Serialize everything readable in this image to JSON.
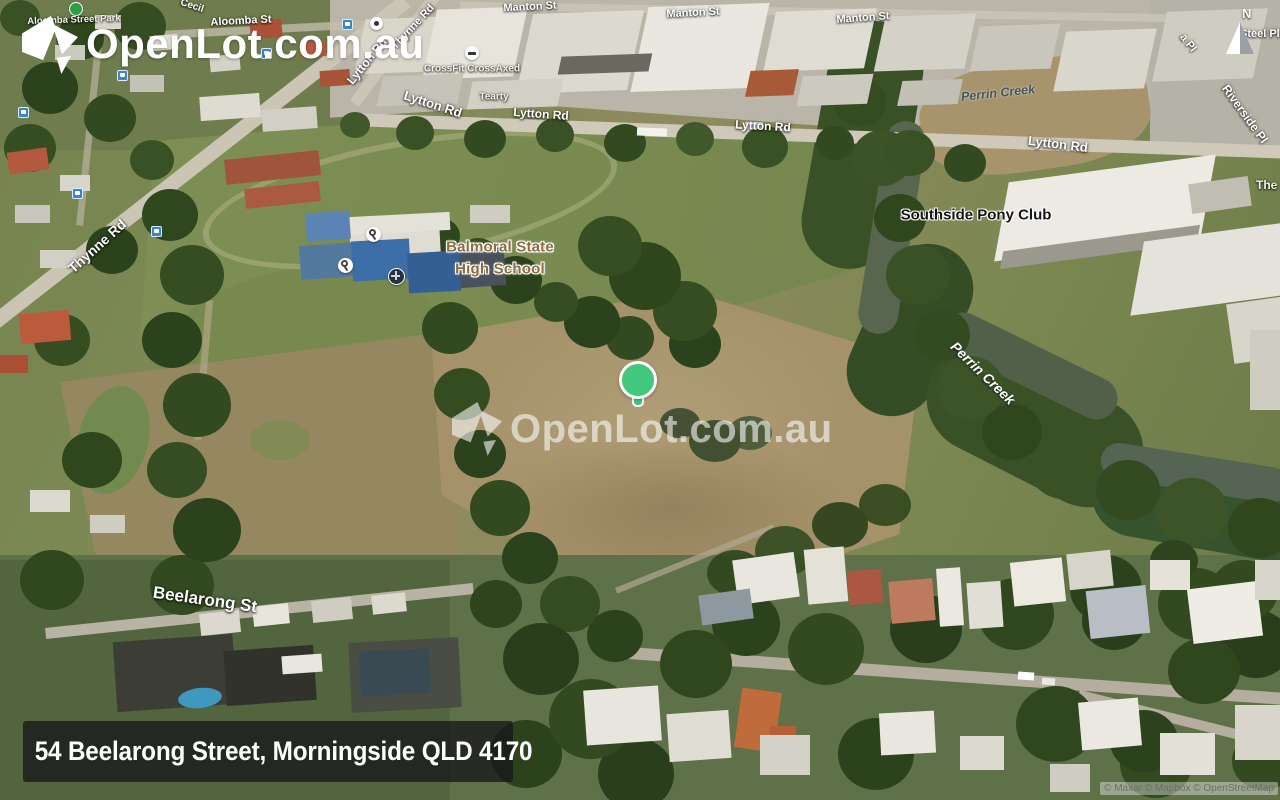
{
  "brand": {
    "logo_text": "OpenLot.com.au",
    "watermark_text": "OpenLot.com.au"
  },
  "address_bar": {
    "text": "54 Beelarong Street, Morningside QLD 4170"
  },
  "attribution": {
    "text": "© Maxar © Mapbox © OpenStreetMap"
  },
  "compass": {
    "label": "N"
  },
  "marker": {
    "color": "#42c87c",
    "outline": "#ffffff"
  },
  "map": {
    "labels": {
      "aloomba_street_park": "Aloomba Street Park",
      "aloomba_st": "Aloomba St",
      "cecil": "Cecil",
      "manton_st": "Manton St",
      "thynne_rd": "Thynne Rd",
      "lytton_rd": "Lytton Rd",
      "perrin_creek": "Perrin Creek",
      "southside_pony_club": "Southside Pony Club",
      "riverside_pl": "Riverside Pl",
      "steel_pl": "Steel Pl",
      "a_pl": "a Pl",
      "the_s": "The S",
      "balmoral_line1": "Balmoral State",
      "balmoral_line2": "High School",
      "beelarong_st": "Beelarong St",
      "crossfit_crossaxed": "CrossFit CrossAxed",
      "tearty": "Tearty"
    }
  }
}
